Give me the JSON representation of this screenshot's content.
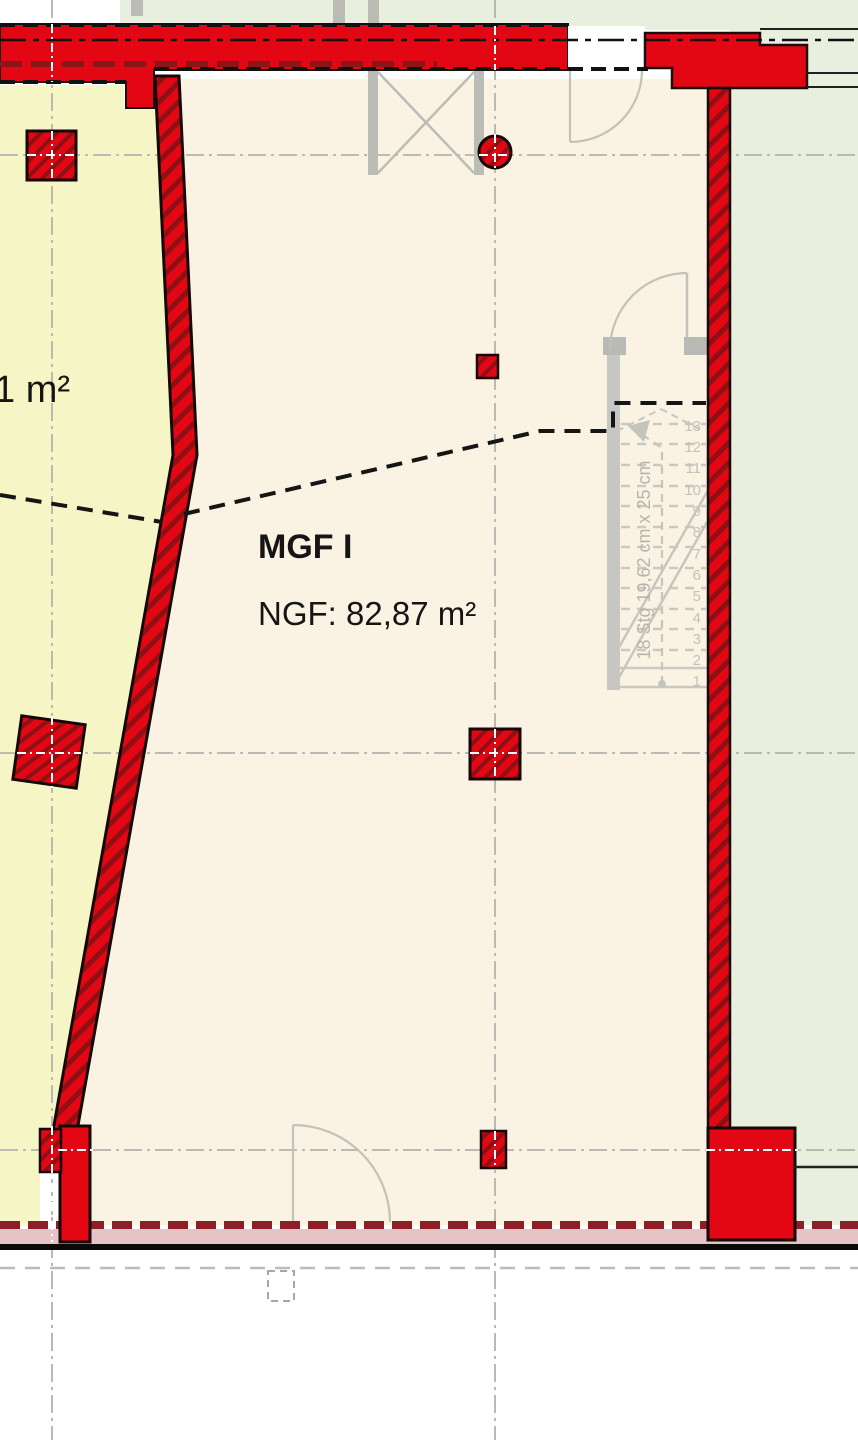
{
  "plan": {
    "room_label": "MGF I",
    "room_area_label": "NGF: 82,87 m²",
    "adjacent_area_label": "1 m²",
    "stair": {
      "dimension_label": "18 Stg 19,62 cm x 25 cm",
      "step_numbers": [
        "13",
        "12",
        "11",
        "10",
        "9",
        "8",
        "7",
        "6",
        "5",
        "4",
        "3",
        "2",
        "1"
      ]
    },
    "colors": {
      "wall_red": "#e30613",
      "wall_hatch_dark": "#8f1014",
      "room_fill": "#faf3e3",
      "adjacent_room_fill": "#f6f5c6",
      "exterior_fill": "#e9efdf",
      "stair_gray": "#c6c6c0",
      "plinth_pink": "#e6c3c6"
    }
  }
}
